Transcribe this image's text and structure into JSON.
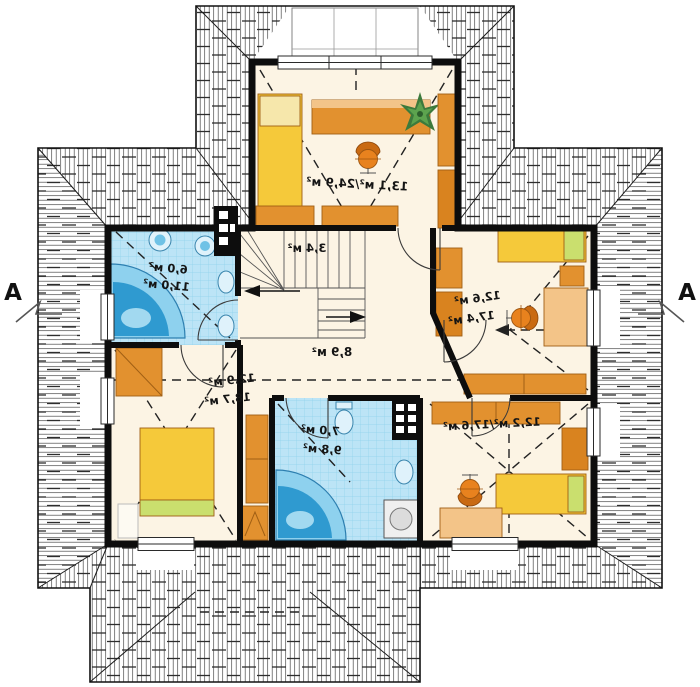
{
  "plan": {
    "section_mark_left": "A",
    "section_mark_right": "A",
    "rooms": {
      "top_bedroom": {
        "area": "13,1 м²/24,9 м²"
      },
      "left_bathroom": {
        "area_line1": "6,0 м²",
        "area_line2": "11,0 м²"
      },
      "staircase": {
        "area": "3,4 м²"
      },
      "hall": {
        "area": "8,9 м²"
      },
      "right_bedroom": {
        "area_line1": "12,6 м²",
        "area_line2": "17,4 м²"
      },
      "bottom_left_bedroom": {
        "area_line1": "12,9 м²",
        "area_line2": "18,7 м²"
      },
      "bottom_bathroom": {
        "area_line1": "7,0 м²",
        "area_line2": "9,8 м²"
      },
      "bottom_right_bedroom": {
        "area": "12,2 м²/17,6 м²"
      }
    },
    "colors": {
      "wall": "#0d0d0d",
      "floor": "#fcf4e4",
      "roof_hatch": "#4a4a4a",
      "tile": "#bce4f6",
      "tile_grid": "#8fd2ec",
      "water_blue": "#2f9ad0",
      "furniture_orange": "#e2912f",
      "furniture_light": "#f3c488",
      "bed_yellow": "#f5c93a",
      "accent_green": "#cadf6e",
      "plant_green": "#3c7a3c"
    }
  }
}
